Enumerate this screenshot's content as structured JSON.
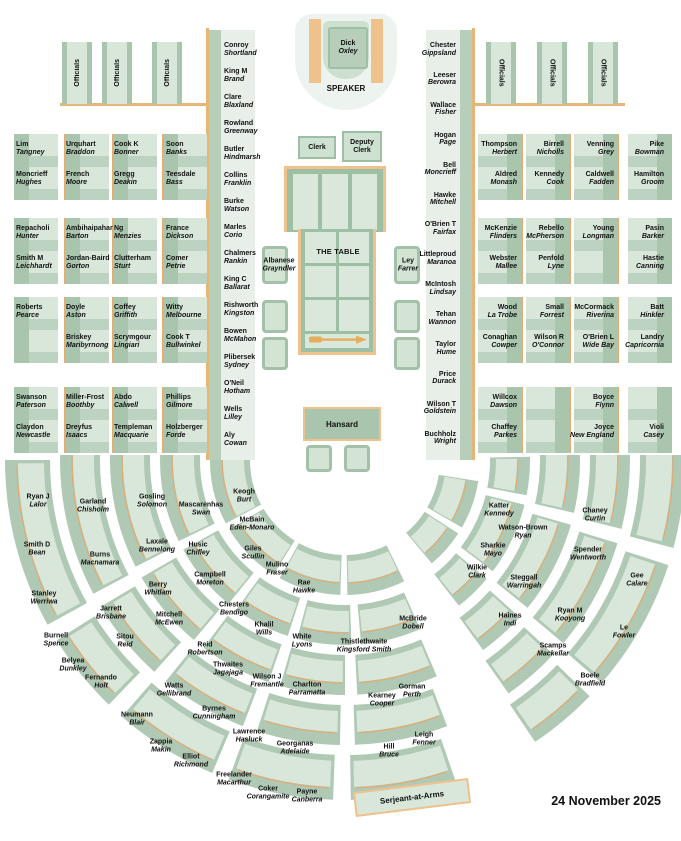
{
  "meta": {
    "date": "24 November 2025"
  },
  "colors": {
    "bench_green": "#a9c5ad",
    "seat_light": "#d9e7da",
    "accent_orange": "#eec18d"
  },
  "speaker": {
    "name": "Dick",
    "electorate": "Oxley",
    "role_label": "SPEAKER"
  },
  "officials": {
    "label": "Officials"
  },
  "clerks": {
    "clerk": "Clerk",
    "deputy_clerk": "Deputy Clerk"
  },
  "table": {
    "label": "THE TABLE"
  },
  "hansard": {
    "label": "Hansard"
  },
  "serjeant": {
    "label": "Serjeant-at-Arms"
  },
  "dispatch_left": {
    "name": "Albanese",
    "electorate": "Grayndler"
  },
  "dispatch_right": {
    "name": "Ley",
    "electorate": "Farrer"
  },
  "left_bench": [
    {
      "name": "Conroy",
      "electorate": "Shortland"
    },
    {
      "name": "King M",
      "electorate": "Brand"
    },
    {
      "name": "Clare",
      "electorate": "Blaxland"
    },
    {
      "name": "Rowland",
      "electorate": "Greenway"
    },
    {
      "name": "Butler",
      "electorate": "Hindmarsh"
    },
    {
      "name": "Collins",
      "electorate": "Franklin"
    },
    {
      "name": "Burke",
      "electorate": "Watson"
    },
    {
      "name": "Marles",
      "electorate": "Corio"
    },
    {
      "name": "Chalmers",
      "electorate": "Rankin"
    },
    {
      "name": "King C",
      "electorate": "Ballarat"
    },
    {
      "name": "Rishworth",
      "electorate": "Kingston"
    },
    {
      "name": "Bowen",
      "electorate": "McMahon"
    },
    {
      "name": "Plibersek",
      "electorate": "Sydney"
    },
    {
      "name": "O'Neil",
      "electorate": "Hotham"
    },
    {
      "name": "Wells",
      "electorate": "Lilley"
    },
    {
      "name": "Aly",
      "electorate": "Cowan"
    }
  ],
  "right_bench": [
    {
      "name": "Chester",
      "electorate": "Gippsland"
    },
    {
      "name": "Leeser",
      "electorate": "Berowra"
    },
    {
      "name": "Wallace",
      "electorate": "Fisher"
    },
    {
      "name": "Hogan",
      "electorate": "Page"
    },
    {
      "name": "Bell",
      "electorate": "Moncrieff"
    },
    {
      "name": "Hawke",
      "electorate": "Mitchell"
    },
    {
      "name": "O'Brien T",
      "electorate": "Fairfax"
    },
    {
      "name": "Littleproud",
      "electorate": "Maranoa"
    },
    {
      "name": "McIntosh",
      "electorate": "Lindsay"
    },
    {
      "name": "Tehan",
      "electorate": "Wannon"
    },
    {
      "name": "Taylor",
      "electorate": "Hume"
    },
    {
      "name": "Price",
      "electorate": "Durack"
    },
    {
      "name": "Wilson T",
      "electorate": "Goldstein"
    },
    {
      "name": "Buchholz",
      "electorate": "Wright"
    }
  ],
  "left_grid": [
    [
      {
        "name": "Lim",
        "electorate": "Tangney"
      },
      {
        "name": "Urquhart",
        "electorate": "Braddon"
      },
      {
        "name": "Cook K",
        "electorate": "Bonner"
      },
      {
        "name": "Soon",
        "electorate": "Banks"
      }
    ],
    [
      {
        "name": "Moncrieff",
        "electorate": "Hughes"
      },
      {
        "name": "French",
        "electorate": "Moore"
      },
      {
        "name": "Gregg",
        "electorate": "Deakin"
      },
      {
        "name": "Teesdale",
        "electorate": "Bass"
      }
    ],
    [
      {
        "name": "Repacholi",
        "electorate": "Hunter"
      },
      {
        "name": "Ambihaipahar",
        "electorate": "Barton"
      },
      {
        "name": "Ng",
        "electorate": "Menzies"
      },
      {
        "name": "France",
        "electorate": "Dickson"
      }
    ],
    [
      {
        "name": "Smith M",
        "electorate": "Leichhardt"
      },
      {
        "name": "Jordan-Baird",
        "electorate": "Gorton"
      },
      {
        "name": "Clutterham",
        "electorate": "Sturt"
      },
      {
        "name": "Comer",
        "electorate": "Petrie"
      }
    ],
    [
      {
        "name": "Roberts",
        "electorate": "Pearce"
      },
      {
        "name": "Doyle",
        "electorate": "Aston"
      },
      {
        "name": "Coffey",
        "electorate": "Griffith"
      },
      {
        "name": "Witty",
        "electorate": "Melbourne"
      }
    ],
    [
      null,
      {
        "name": "Briskey",
        "electorate": "Maribyrnong"
      },
      {
        "name": "Scrymgour",
        "electorate": "Lingiari"
      },
      {
        "name": "Cook T",
        "electorate": "Bullwinkel"
      }
    ],
    [
      {
        "name": "Swanson",
        "electorate": "Paterson"
      },
      {
        "name": "Miller-Frost",
        "electorate": "Boothby"
      },
      {
        "name": "Abdo",
        "electorate": "Calwell"
      },
      {
        "name": "Phillips",
        "electorate": "Gilmore"
      }
    ],
    [
      {
        "name": "Claydon",
        "electorate": "Newcastle"
      },
      {
        "name": "Dreyfus",
        "electorate": "Isaacs"
      },
      {
        "name": "Templeman",
        "electorate": "Macquarie"
      },
      {
        "name": "Holzberger",
        "electorate": "Forde"
      }
    ]
  ],
  "right_grid": [
    [
      {
        "name": "Thompson",
        "electorate": "Herbert"
      },
      {
        "name": "Birrell",
        "electorate": "Nicholls"
      },
      {
        "name": "Venning",
        "electorate": "Grey"
      },
      {
        "name": "Pike",
        "electorate": "Bowman"
      }
    ],
    [
      {
        "name": "Aldred",
        "electorate": "Monash"
      },
      {
        "name": "Kennedy",
        "electorate": "Cook"
      },
      {
        "name": "Caldwell",
        "electorate": "Fadden"
      },
      {
        "name": "Hamilton",
        "electorate": "Groom"
      }
    ],
    [
      {
        "name": "McKenzie",
        "electorate": "Flinders"
      },
      {
        "name": "Rebello",
        "electorate": "McPherson"
      },
      {
        "name": "Young",
        "electorate": "Longman"
      },
      {
        "name": "Pasin",
        "electorate": "Barker"
      }
    ],
    [
      {
        "name": "Webster",
        "electorate": "Mallee"
      },
      {
        "name": "Penfold",
        "electorate": "Lyne"
      },
      null,
      {
        "name": "Hastie",
        "electorate": "Canning"
      }
    ],
    [
      {
        "name": "Wood",
        "electorate": "La Trobe"
      },
      {
        "name": "Small",
        "electorate": "Forrest"
      },
      {
        "name": "McCormack",
        "electorate": "Riverina"
      },
      {
        "name": "Batt",
        "electorate": "Hinkler"
      }
    ],
    [
      {
        "name": "Conaghan",
        "electorate": "Cowper"
      },
      {
        "name": "Wilson R",
        "electorate": "O'Connor"
      },
      {
        "name": "O'Brien L",
        "electorate": "Wide Bay"
      },
      {
        "name": "Landry",
        "electorate": "Capricornia"
      }
    ],
    [
      {
        "name": "Willcox",
        "electorate": "Dawson"
      },
      null,
      {
        "name": "Boyce",
        "electorate": "Flynn"
      },
      null
    ],
    [
      {
        "name": "Chaffey",
        "electorate": "Parkes"
      },
      null,
      {
        "name": "Joyce",
        "electorate": "New England"
      },
      {
        "name": "Violi",
        "electorate": "Casey"
      }
    ]
  ],
  "floor_seats": [
    {
      "name": "Ryan J",
      "electorate": "Lalor",
      "x": 38,
      "y": 501
    },
    {
      "name": "Smith D",
      "electorate": "Bean",
      "x": 37,
      "y": 549
    },
    {
      "name": "Stanley",
      "electorate": "Werriwa",
      "x": 44,
      "y": 598
    },
    {
      "name": "Burnell",
      "electorate": "Spence",
      "x": 56,
      "y": 640
    },
    {
      "name": "Belyea",
      "electorate": "Dunkley",
      "x": 73,
      "y": 665
    },
    {
      "name": "Fernando",
      "electorate": "Holt",
      "x": 101,
      "y": 682
    },
    {
      "name": "Neumann",
      "electorate": "Blair",
      "x": 137,
      "y": 719
    },
    {
      "name": "Zappia",
      "electorate": "Makin",
      "x": 161,
      "y": 746
    },
    {
      "name": "Elliot",
      "electorate": "Richmond",
      "x": 191,
      "y": 761
    },
    {
      "name": "Freelander",
      "electorate": "Macarthur",
      "x": 234,
      "y": 779
    },
    {
      "name": "Coker",
      "electorate": "Corangamite",
      "x": 268,
      "y": 793
    },
    {
      "name": "Payne",
      "electorate": "Canberra",
      "x": 307,
      "y": 796
    },
    {
      "name": "Garland",
      "electorate": "Chisholm",
      "x": 93,
      "y": 506
    },
    {
      "name": "Burns",
      "electorate": "Macnamara",
      "x": 100,
      "y": 559
    },
    {
      "name": "Jarrett",
      "electorate": "Brisbane",
      "x": 111,
      "y": 613
    },
    {
      "name": "Sitou",
      "electorate": "Reid",
      "x": 125,
      "y": 641
    },
    {
      "name": "Watts",
      "electorate": "Gellibrand",
      "x": 174,
      "y": 690
    },
    {
      "name": "Byrnes",
      "electorate": "Cunningham",
      "x": 214,
      "y": 713
    },
    {
      "name": "Lawrence",
      "electorate": "Hasluck",
      "x": 249,
      "y": 736
    },
    {
      "name": "Georganas",
      "electorate": "Adelaide",
      "x": 295,
      "y": 748
    },
    {
      "name": "Gosling",
      "electorate": "Solomon",
      "x": 152,
      "y": 501
    },
    {
      "name": "Laxale",
      "electorate": "Bennelong",
      "x": 157,
      "y": 546
    },
    {
      "name": "Berry",
      "electorate": "Whitlam",
      "x": 158,
      "y": 589
    },
    {
      "name": "Mitchell",
      "electorate": "McEwen",
      "x": 169,
      "y": 619
    },
    {
      "name": "Reid",
      "electorate": "Robertson",
      "x": 205,
      "y": 649
    },
    {
      "name": "Thwaites",
      "electorate": "Jagajaga",
      "x": 228,
      "y": 669
    },
    {
      "name": "Wilson J",
      "electorate": "Fremantle",
      "x": 267,
      "y": 681
    },
    {
      "name": "Charlton",
      "electorate": "Parramatta",
      "x": 307,
      "y": 689
    },
    {
      "name": "Mascarenhas",
      "electorate": "Swan",
      "x": 201,
      "y": 509
    },
    {
      "name": "Husic",
      "electorate": "Chifley",
      "x": 198,
      "y": 549
    },
    {
      "name": "Campbell",
      "electorate": "Moreton",
      "x": 210,
      "y": 579
    },
    {
      "name": "Chesters",
      "electorate": "Bendigo",
      "x": 234,
      "y": 609
    },
    {
      "name": "Khalil",
      "electorate": "Wills",
      "x": 264,
      "y": 629
    },
    {
      "name": "White",
      "electorate": "Lyons",
      "x": 302,
      "y": 641
    },
    {
      "name": "Keogh",
      "electorate": "Burt",
      "x": 244,
      "y": 496
    },
    {
      "name": "McBain",
      "electorate": "Eden-Monaro",
      "x": 252,
      "y": 524
    },
    {
      "name": "Giles",
      "electorate": "Scullin",
      "x": 253,
      "y": 553
    },
    {
      "name": "Mulino",
      "electorate": "Fraser",
      "x": 277,
      "y": 569
    },
    {
      "name": "Rae",
      "electorate": "Hawke",
      "x": 304,
      "y": 587
    },
    {
      "name": "Thistlethwaite",
      "electorate": "Kingsford Smith",
      "x": 364,
      "y": 646
    },
    {
      "name": "McBride",
      "electorate": "Dobell",
      "x": 413,
      "y": 623
    },
    {
      "name": "Kearney",
      "electorate": "Cooper",
      "x": 382,
      "y": 700
    },
    {
      "name": "Gorman",
      "electorate": "Perth",
      "x": 412,
      "y": 691
    },
    {
      "name": "Hill",
      "electorate": "Bruce",
      "x": 389,
      "y": 751
    },
    {
      "name": "Leigh",
      "electorate": "Fenner",
      "x": 424,
      "y": 739
    },
    {
      "name": "Katter",
      "electorate": "Kennedy",
      "x": 499,
      "y": 510
    },
    {
      "name": "Watson-Brown",
      "electorate": "Ryan",
      "x": 523,
      "y": 532
    },
    {
      "name": "Sharkie",
      "electorate": "Mayo",
      "x": 493,
      "y": 550
    },
    {
      "name": "Wilkie",
      "electorate": "Clark",
      "x": 477,
      "y": 572
    },
    {
      "name": "Steggall",
      "electorate": "Warringah",
      "x": 524,
      "y": 582
    },
    {
      "name": "Haines",
      "electorate": "Indi",
      "x": 510,
      "y": 620
    },
    {
      "name": "Chaney",
      "electorate": "Curtin",
      "x": 595,
      "y": 515
    },
    {
      "name": "Spender",
      "electorate": "Wentworth",
      "x": 588,
      "y": 554
    },
    {
      "name": "Ryan M",
      "electorate": "Kooyong",
      "x": 570,
      "y": 615
    },
    {
      "name": "Scamps",
      "electorate": "Mackellar",
      "x": 553,
      "y": 650
    },
    {
      "name": "Gee",
      "electorate": "Calare",
      "x": 637,
      "y": 580
    },
    {
      "name": "Le",
      "electorate": "Fowler",
      "x": 624,
      "y": 632
    },
    {
      "name": "Boele",
      "electorate": "Bradfield",
      "x": 590,
      "y": 680
    }
  ]
}
